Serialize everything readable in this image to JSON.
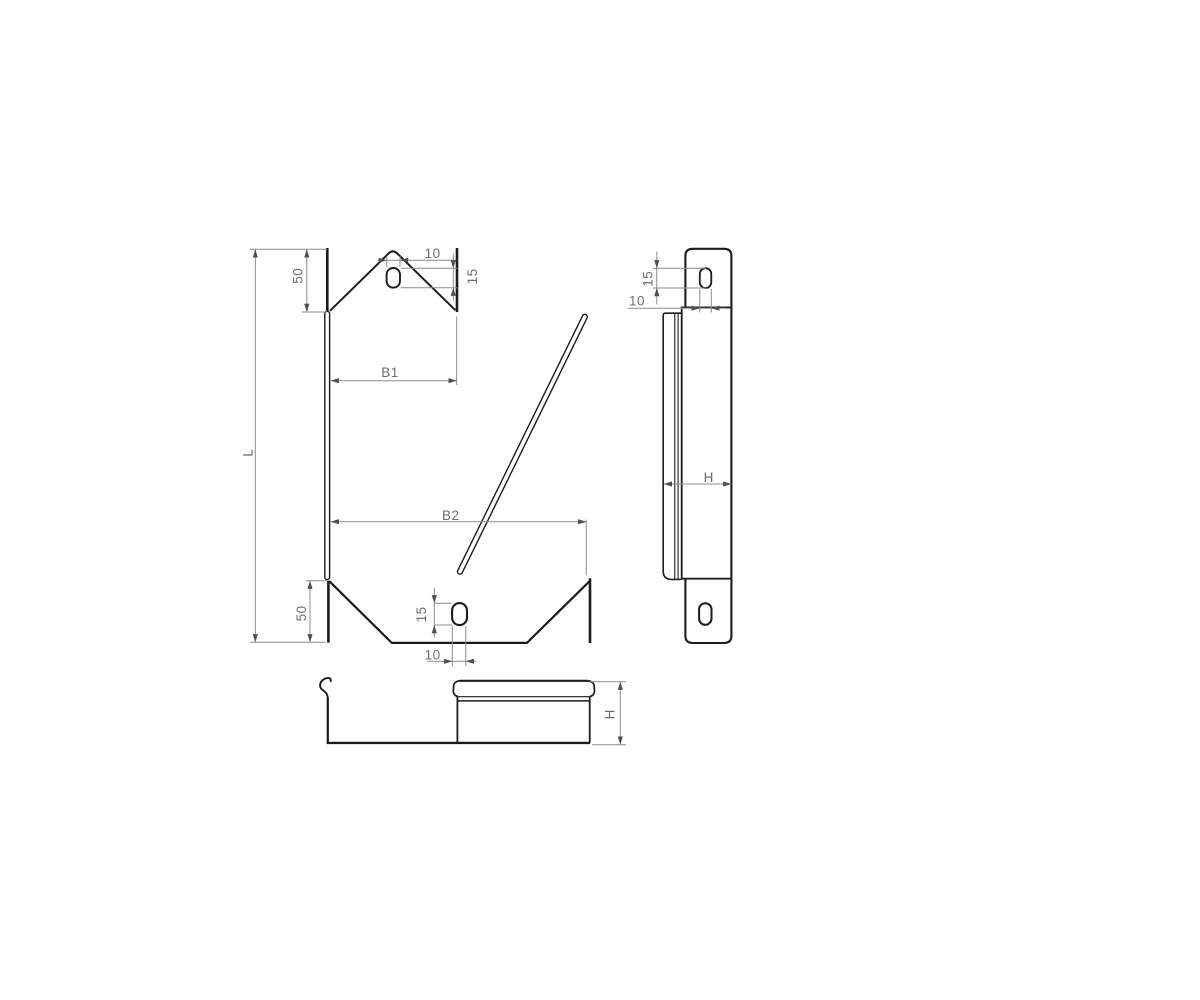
{
  "drawing": {
    "background_color": "#ffffff",
    "outline_color": "#1c1c1c",
    "dimension_line_color": "#8c8c8c",
    "dimension_text_color": "#6e6e6e",
    "views": {
      "front_view": {
        "labels": {
          "length": "L",
          "end_section_top": "50",
          "end_section_bottom": "50",
          "width_top": "B1",
          "width_bottom": "B2",
          "slot_width_top": "10",
          "slot_height_top": "15",
          "slot_height_bottom": "15",
          "slot_width_bottom": "10"
        }
      },
      "side_view": {
        "labels": {
          "slot_height": "15",
          "slot_width": "10",
          "height": "H"
        }
      },
      "section_view": {
        "labels": {
          "height": "H"
        }
      }
    }
  }
}
